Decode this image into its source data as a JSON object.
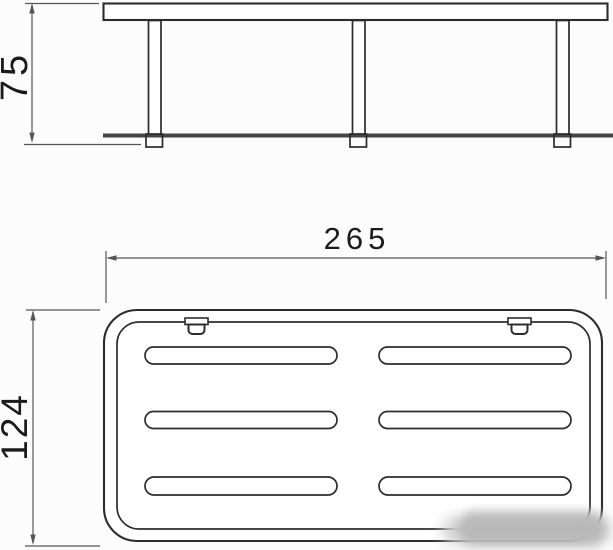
{
  "colors": {
    "background": "#fcfcfc",
    "line": "#2c2c2c",
    "dim": "#565656",
    "shelf_edge": "#454545",
    "watermark": "#b9b9b9",
    "label": "#1b1b1b"
  },
  "dimensions": {
    "side_height": {
      "label": "75"
    },
    "top_width": {
      "label": "265"
    },
    "top_depth": {
      "label": "124"
    }
  },
  "top_view": {
    "slot_rows": 3,
    "slot_columns": 2,
    "mounting_tabs": 2
  }
}
